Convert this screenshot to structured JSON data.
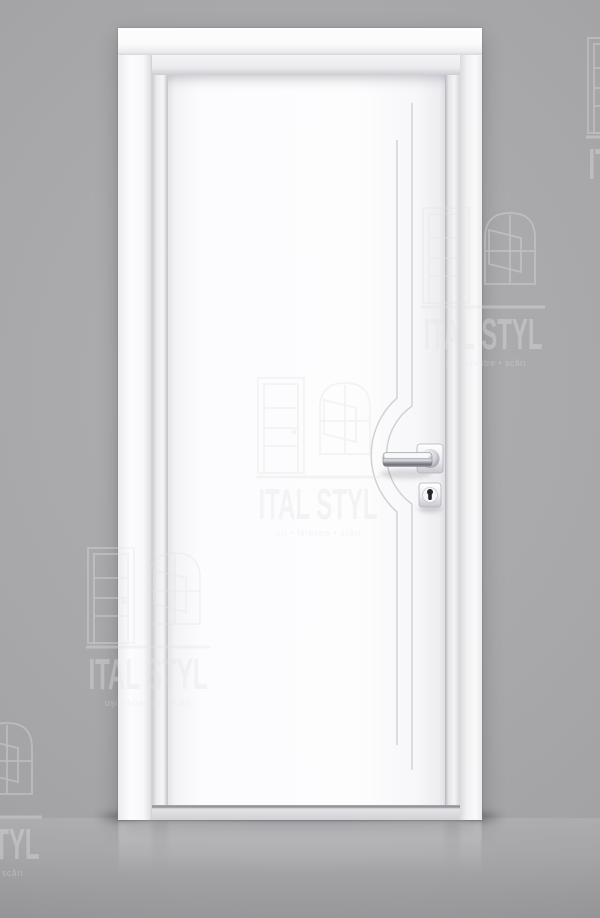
{
  "brand": {
    "name": "ITAL STYL",
    "tagline": "uși • ferestre • scări"
  },
  "colors": {
    "background_gray": "#a7a7a9",
    "door_white": "#fcfcfd",
    "chrome_handle": "#c6c8cd",
    "keyhole_dark": "#26262b",
    "watermark_light": "#e4e4e4"
  },
  "icons": {
    "watermark_door": "door-outline-icon",
    "watermark_window": "arched-window-icon",
    "keyhole": "keyhole-icon"
  }
}
